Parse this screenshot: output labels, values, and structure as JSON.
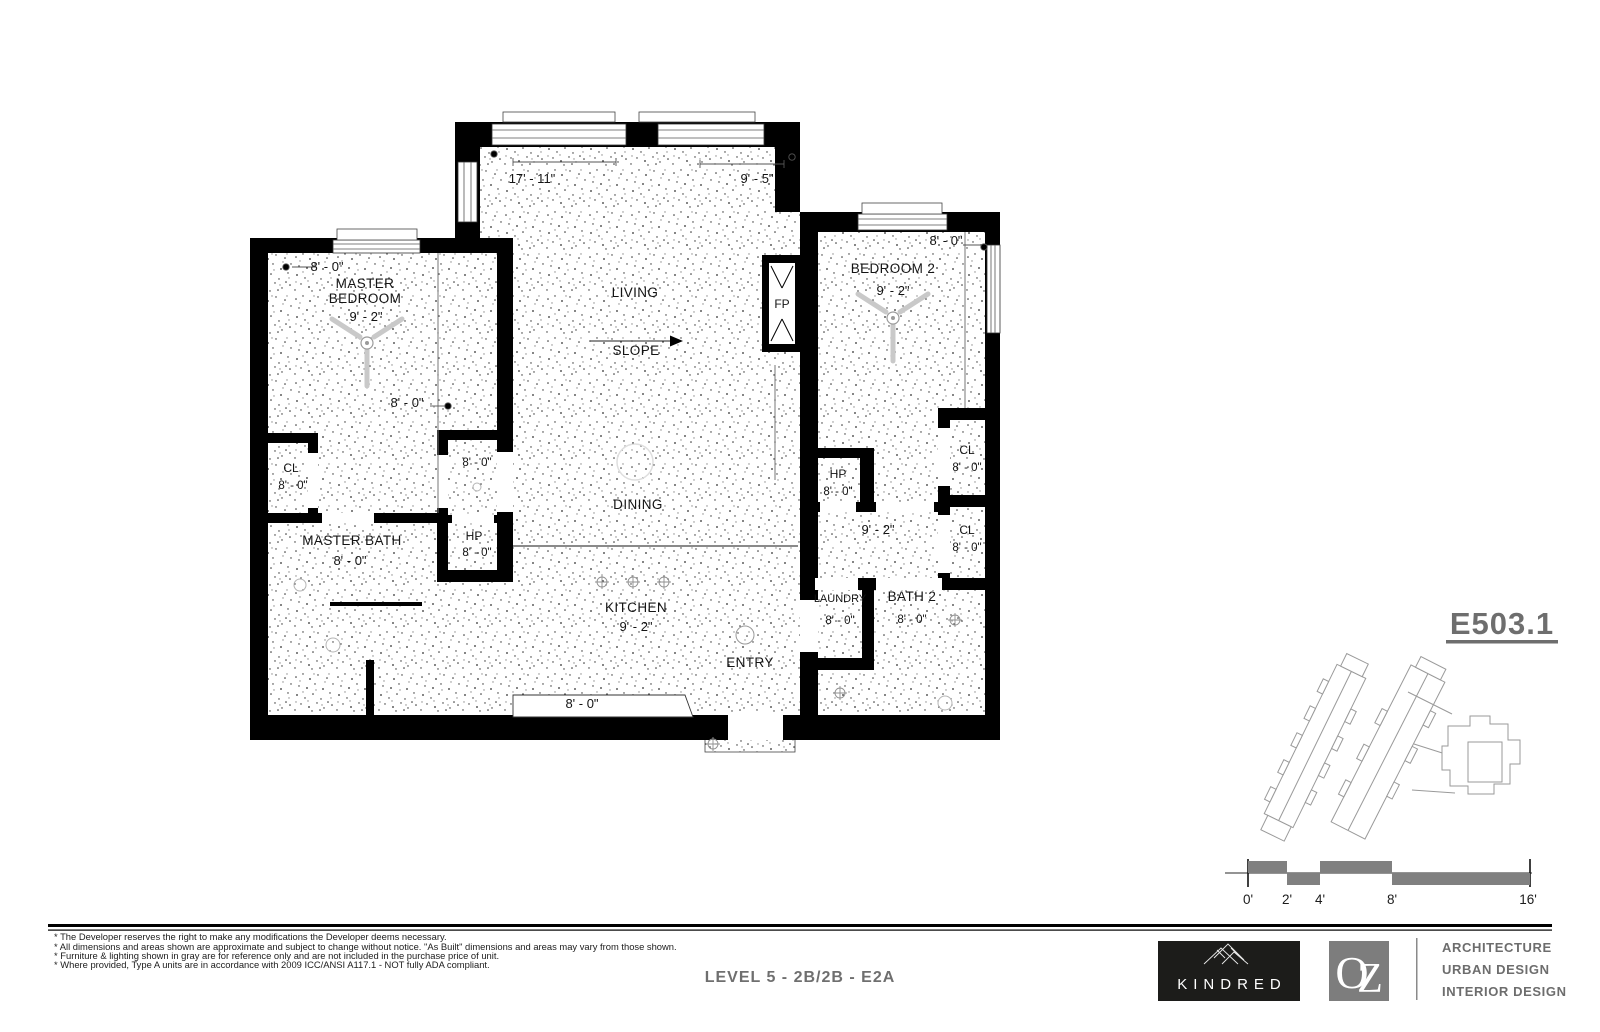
{
  "sheet": {
    "number": "E503.1",
    "title": "LEVEL 5 - 2B/2B - E2A"
  },
  "plan": {
    "living": "LIVING",
    "slope": "SLOPE",
    "dining": "DINING",
    "kitchen": "KITCHEN",
    "kitchen_h": "9' - 2\"",
    "entry": "ENTRY",
    "fireplace": "FP",
    "master_1": "MASTER",
    "master_2": "BEDROOM",
    "master_h": "9' - 2\"",
    "master_dim_top": "8' - 0\"",
    "master_dim_mid": "8' - 0\"",
    "master_bath": "MASTER BATH",
    "master_bath_h": "8' - 0\"",
    "cl_master": "CL",
    "cl_master_h": "8' - 0\"",
    "closet_h": "8' - 0\"",
    "hp_left": "HP",
    "hp_left_h": "8' - 0\"",
    "bedroom2": "BEDROOM 2",
    "bedroom2_h": "9' - 2\"",
    "bedroom2_dim": "8' - 0\"",
    "hp_right": "HP",
    "hp_right_h": "8' - 0\"",
    "hall_h": "9' - 2\"",
    "cl_upper": "CL",
    "cl_upper_h": "8' - 0\"",
    "cl_lower": "CL",
    "cl_lower_h": "8' - 0\"",
    "laundry": "LAUNDRY",
    "laundry_h": "8' - 0\"",
    "bath2": "BATH 2",
    "bath2_h": "8' - 0\"",
    "dim_top_left": "17' - 11\"",
    "dim_top_right": "9' - 5\"",
    "dim_kitchen_bottom": "8' - 0\""
  },
  "scale_bar": {
    "ticks": [
      "0'",
      "2'",
      "4'",
      "8'",
      "16'"
    ]
  },
  "notes": [
    "* The Developer reserves the right to make any modifications the Developer deems necessary.",
    "* All dimensions and areas shown are approximate and subject to change without notice. \"As Built\" dimensions and areas may vary from those shown.",
    "* Furniture & lighting shown in gray are for reference only and are not included in the purchase price of unit.",
    "* Where provided, Type A units are in accordance with 2009 ICC/ANSI A117.1 - NOT fully ADA compliant."
  ],
  "branding": {
    "kindred": "KINDRED",
    "oz": "OZ",
    "services": [
      "ARCHITECTURE",
      "URBAN DESIGN",
      "INTERIOR DESIGN"
    ]
  },
  "colors": {
    "wall": "#000000",
    "annotation_gray": "#6f6f6f",
    "scale_gray": "#808080",
    "kindred_bg": "#1c1c1a",
    "oz_bg": "#7d7d7d"
  }
}
